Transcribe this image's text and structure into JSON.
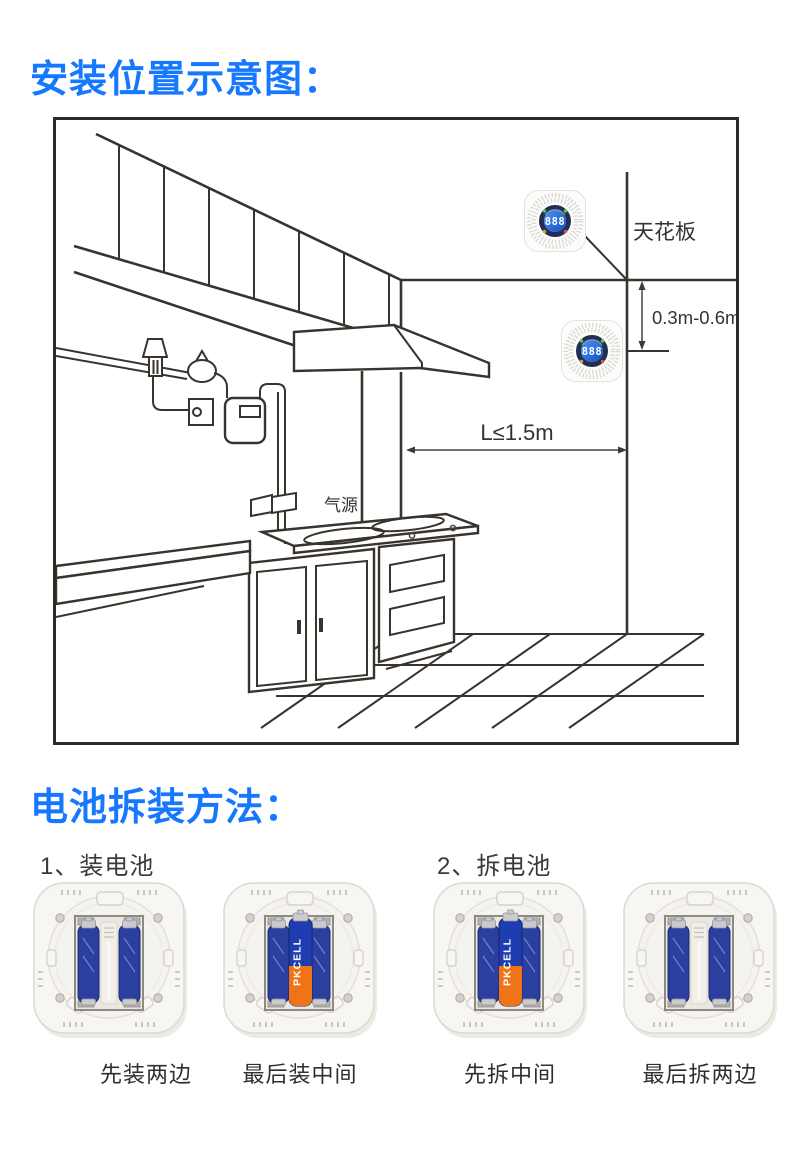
{
  "titles": {
    "install": "安装位置示意图：",
    "battery": "电池拆装方法："
  },
  "install_diagram": {
    "ceiling_label": "天花板",
    "ceiling_distance": "0.3m-0.6m",
    "horizontal_distance": "L≤1.5m",
    "gas_source_label": "气源",
    "detector_display": "888"
  },
  "battery_section": {
    "step1_label": "1、装电池",
    "step2_label": "2、拆电池",
    "images": [
      {
        "caption": "先装两边",
        "middle_battery": false
      },
      {
        "caption": "最后装中间",
        "middle_battery": true,
        "battery_brand": "PKCELL"
      },
      {
        "caption": "先拆中间",
        "middle_battery": true,
        "battery_brand": "PKCELL"
      },
      {
        "caption": "最后拆两边",
        "middle_battery": false
      }
    ]
  },
  "colors": {
    "accent": "#1677ff",
    "line_art": "#39332d"
  }
}
